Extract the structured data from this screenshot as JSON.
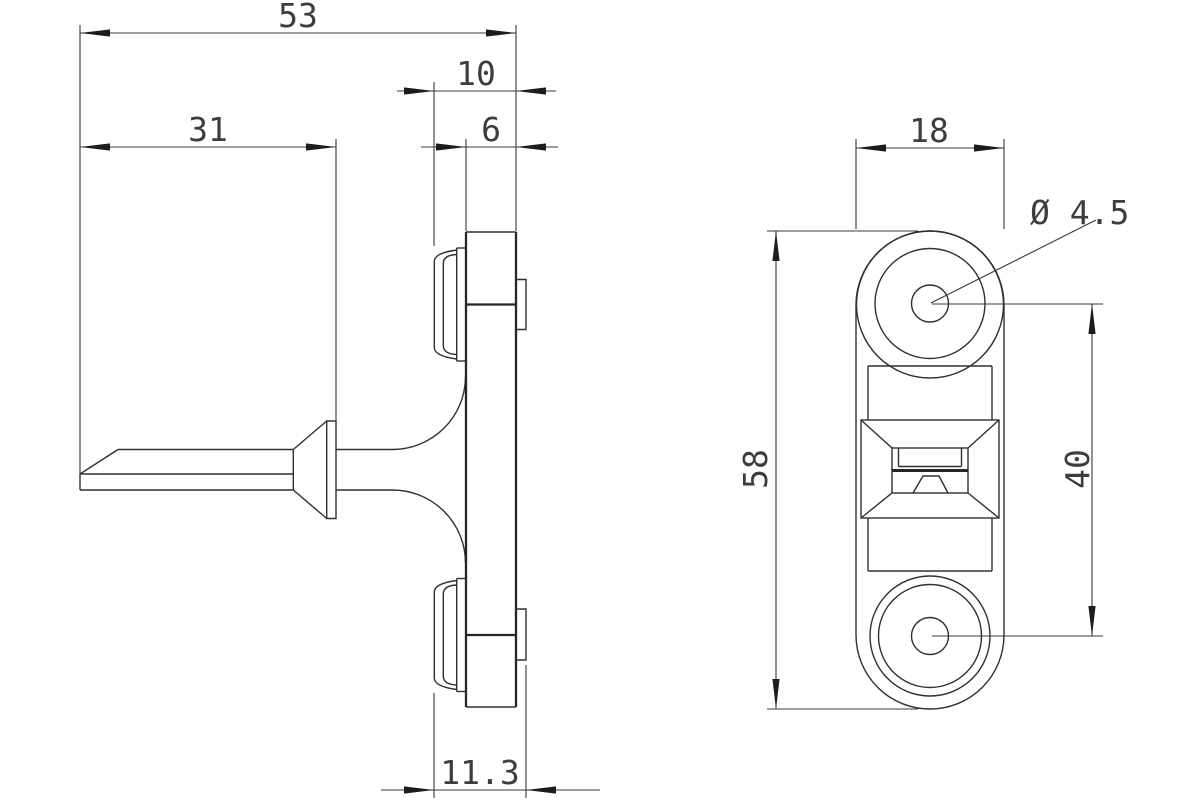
{
  "drawing": {
    "description": "two-view engineering drawing of a door catch strike fitting",
    "background": "#ffffff",
    "line_color": "#303030",
    "text_color": "#3d3d3d",
    "views": {
      "side": {
        "label": "side profile view",
        "dims": {
          "overall_depth": "53",
          "face_to_plate_back": "10",
          "pin_length": "31",
          "plate_thickness": "6",
          "overall_stack": "11.3"
        }
      },
      "front": {
        "label": "front view",
        "dims": {
          "plate_width": "18",
          "plate_height": "58",
          "hole_spacing": "40",
          "hole_diameter": "Ø 4.5"
        }
      }
    }
  }
}
